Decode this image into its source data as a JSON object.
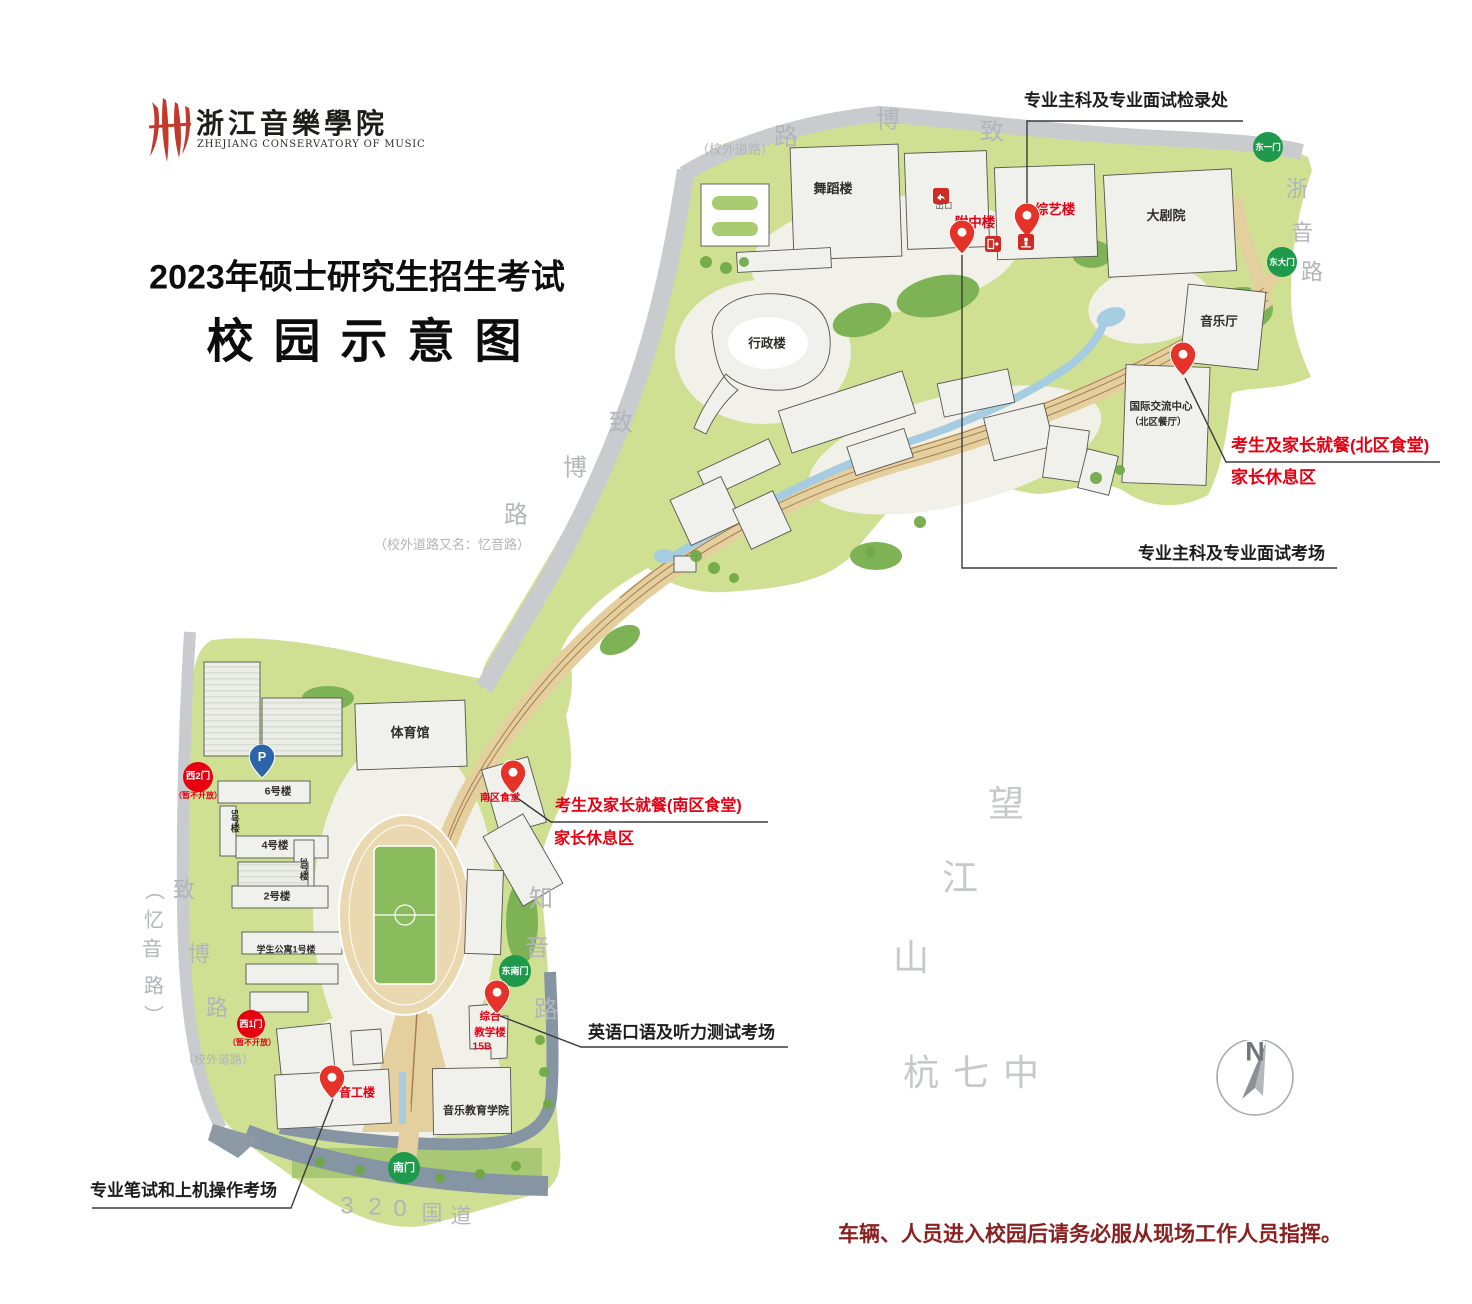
{
  "header": {
    "logo_cn": "浙江音樂學院",
    "logo_en": "ZHEJIANG CONSERVATORY OF MUSIC",
    "title_line1": "2023年硕士研究生招生考试",
    "title_line2": "校园示意图"
  },
  "map": {
    "notice": "车辆、人员进入校园后请务必服从现场工作人员指挥。",
    "compass_n": "N",
    "colors": {
      "campus_green": "#cfe092",
      "dark_green": "#7db354",
      "road_gray": "#c9cbce",
      "road_blue_gray": "#8695a4",
      "path_tan": "#e4cf9f",
      "water_blue": "#a5cce0",
      "accent_red": "#e60012",
      "gate_green": "#1f9a4c",
      "notice_dark_red": "#8a2121"
    },
    "labels": [
      {
        "n": "building-label-wudaolou",
        "t": "舞蹈楼",
        "x": 833,
        "y": 189,
        "fs": 13,
        "c": "b"
      },
      {
        "n": "building-label-dajuyuan",
        "t": "大剧院",
        "x": 1166,
        "y": 216,
        "fs": 13,
        "c": "b"
      },
      {
        "n": "building-label-yinyueting",
        "t": "音乐厅",
        "x": 1219,
        "y": 322,
        "fs": 12.5,
        "c": "b"
      },
      {
        "n": "building-label-xingzhenglou",
        "t": "行政楼",
        "x": 767,
        "y": 344,
        "fs": 12.5,
        "c": "b"
      },
      {
        "n": "building-label-guojijiaoliu",
        "t": "国际交流中心",
        "x": 1161,
        "y": 407,
        "fs": 10.5,
        "c": "b"
      },
      {
        "n": "building-label-beiqucanting",
        "t": "（北区餐厅）",
        "x": 1158,
        "y": 423,
        "fs": 9.5,
        "c": "b"
      },
      {
        "n": "building-label-tiyuguan",
        "t": "体育馆",
        "x": 410,
        "y": 733,
        "fs": 13,
        "c": "b"
      },
      {
        "n": "building-label-6haolou",
        "t": "6号楼",
        "x": 278,
        "y": 792,
        "fs": 10.5,
        "c": "b"
      },
      {
        "n": "building-label-4haolou",
        "t": "4号楼",
        "x": 275,
        "y": 846,
        "fs": 10.5,
        "c": "b"
      },
      {
        "n": "building-label-2haolou",
        "t": "2号楼",
        "x": 277,
        "y": 897,
        "fs": 10.5,
        "c": "b"
      },
      {
        "n": "building-label-5haolou",
        "t": "5号楼",
        "x": 234,
        "y": 821,
        "fs": 9,
        "c": "b",
        "v": true
      },
      {
        "n": "building-label-3haolou",
        "t": "3号楼",
        "x": 303,
        "y": 869,
        "fs": 9,
        "c": "b",
        "v": true
      },
      {
        "n": "building-label-xueshengongyu",
        "t": "学生公寓1号楼",
        "x": 286,
        "y": 950,
        "fs": 9,
        "c": "b"
      },
      {
        "n": "building-label-yinyuejiaoyu",
        "t": "音乐教育学院",
        "x": 476,
        "y": 1112,
        "fs": 11,
        "c": "b"
      },
      {
        "n": "exit-label",
        "t": "出口",
        "x": 944,
        "y": 206,
        "fs": 8.5,
        "c": "dim"
      },
      {
        "n": "building-label-fuzhonglou",
        "t": "附中楼",
        "x": 975,
        "y": 223,
        "fs": 13.5,
        "c": "r"
      },
      {
        "n": "building-label-zongyilou",
        "t": "综艺楼",
        "x": 1055,
        "y": 210,
        "fs": 13.5,
        "c": "r"
      },
      {
        "n": "building-label-nanqushitang",
        "t": "南区食堂",
        "x": 500,
        "y": 799,
        "fs": 10,
        "c": "r"
      },
      {
        "n": "building-label-zonghe",
        "t": "综合",
        "x": 490,
        "y": 1017,
        "fs": 10.5,
        "c": "r"
      },
      {
        "n": "building-label-jiaoxuelou",
        "t": "教学楼",
        "x": 490,
        "y": 1033,
        "fs": 10.5,
        "c": "r"
      },
      {
        "n": "building-label-15b",
        "t": "15B",
        "x": 482,
        "y": 1047,
        "fs": 10.5,
        "c": "r"
      },
      {
        "n": "building-label-yingonglou",
        "t": "音工楼",
        "x": 357,
        "y": 1093,
        "fs": 12,
        "c": "r"
      },
      {
        "n": "annotation-checkin",
        "t": "专业主科及专业面试检录处",
        "x": 1024,
        "y": 101,
        "fs": 17,
        "c": "an",
        "a": "l"
      },
      {
        "n": "annotation-interview-room",
        "t": "专业主科及专业面试考场",
        "x": 1138,
        "y": 554,
        "fs": 17,
        "c": "an",
        "a": "l"
      },
      {
        "n": "annotation-north-dining-1",
        "t": "考生及家长就餐(北区食堂)",
        "x": 1231,
        "y": 446,
        "fs": 17,
        "c": "ar",
        "a": "l"
      },
      {
        "n": "annotation-north-dining-2",
        "t": "家长休息区",
        "x": 1231,
        "y": 478,
        "fs": 17,
        "c": "ar",
        "a": "l"
      },
      {
        "n": "annotation-south-dining-1",
        "t": "考生及家长就餐(南区食堂)",
        "x": 555,
        "y": 807,
        "fs": 16,
        "c": "ar",
        "a": "l"
      },
      {
        "n": "annotation-south-dining-2",
        "t": "家长休息区",
        "x": 554,
        "y": 840,
        "fs": 16,
        "c": "ar",
        "a": "l"
      },
      {
        "n": "annotation-english-test",
        "t": "英语口语及听力测试考场",
        "x": 588,
        "y": 1033,
        "fs": 17,
        "c": "an",
        "a": "l"
      },
      {
        "n": "annotation-written-test",
        "t": "专业笔试和上机操作考场",
        "x": 90,
        "y": 1191,
        "fs": 17,
        "c": "an",
        "a": "l"
      },
      {
        "n": "gate-note-west2",
        "t": "（暂不开放）",
        "x": 198,
        "y": 796,
        "fs": 8,
        "c": "r"
      },
      {
        "n": "gate-note-west1",
        "t": "（暂不开放）",
        "x": 252,
        "y": 1043,
        "fs": 8,
        "c": "r"
      },
      {
        "n": "road-note-top",
        "t": "（校外道路）",
        "x": 735,
        "y": 150,
        "fs": 13,
        "c": "g"
      },
      {
        "n": "road-label-lu-top",
        "t": "路",
        "x": 786,
        "y": 137,
        "fs": 24,
        "c": "g"
      },
      {
        "n": "road-label-bo-top",
        "t": "博",
        "x": 888,
        "y": 120,
        "fs": 24,
        "c": "g"
      },
      {
        "n": "road-label-zhi-top",
        "t": "致",
        "x": 992,
        "y": 132,
        "fs": 24,
        "c": "g"
      },
      {
        "n": "road-label-zhe",
        "t": "浙",
        "x": 1297,
        "y": 189,
        "fs": 22,
        "c": "g"
      },
      {
        "n": "road-label-yin-east",
        "t": "音",
        "x": 1302,
        "y": 233,
        "fs": 22,
        "c": "g"
      },
      {
        "n": "road-label-lu-east",
        "t": "路",
        "x": 1312,
        "y": 272,
        "fs": 22,
        "c": "g"
      },
      {
        "n": "road-label-zhi-mid",
        "t": "致",
        "x": 621,
        "y": 423,
        "fs": 24,
        "c": "g"
      },
      {
        "n": "road-label-bo-mid",
        "t": "博",
        "x": 575,
        "y": 468,
        "fs": 24,
        "c": "g"
      },
      {
        "n": "road-label-lu-mid",
        "t": "路",
        "x": 516,
        "y": 515,
        "fs": 24,
        "c": "g"
      },
      {
        "n": "road-note-mid",
        "t": "（校外道路又名：忆音路）",
        "x": 452,
        "y": 545,
        "fs": 13,
        "c": "g"
      },
      {
        "n": "road-label-paren-open",
        "t": "（",
        "x": 152,
        "y": 890,
        "fs": 20,
        "c": "g",
        "v": true
      },
      {
        "n": "road-label-yi-west",
        "t": "忆",
        "x": 154,
        "y": 921,
        "fs": 20,
        "c": "g"
      },
      {
        "n": "road-label-yin-west",
        "t": "音",
        "x": 152,
        "y": 950,
        "fs": 20,
        "c": "g"
      },
      {
        "n": "road-label-lu-west",
        "t": "路",
        "x": 154,
        "y": 987,
        "fs": 20,
        "c": "g"
      },
      {
        "n": "road-label-paren-close",
        "t": "）",
        "x": 151,
        "y": 1015,
        "fs": 20,
        "c": "g",
        "v": true
      },
      {
        "n": "road-label-zhi-sw",
        "t": "致",
        "x": 184,
        "y": 890,
        "fs": 22,
        "c": "g"
      },
      {
        "n": "road-label-bo-sw",
        "t": "博",
        "x": 199,
        "y": 954,
        "fs": 22,
        "c": "g"
      },
      {
        "n": "road-label-lu-sw",
        "t": "路",
        "x": 217,
        "y": 1008,
        "fs": 22,
        "c": "g"
      },
      {
        "n": "road-note-sw",
        "t": "（校外道路）",
        "x": 218,
        "y": 1060,
        "fs": 12,
        "c": "g"
      },
      {
        "n": "road-label-zhi2",
        "t": "知",
        "x": 541,
        "y": 899,
        "fs": 24,
        "c": "g"
      },
      {
        "n": "road-label-yin2",
        "t": "音",
        "x": 537,
        "y": 948,
        "fs": 24,
        "c": "g"
      },
      {
        "n": "road-label-lu2",
        "t": "路",
        "x": 546,
        "y": 1010,
        "fs": 24,
        "c": "g"
      },
      {
        "n": "area-label-wang",
        "t": "望",
        "x": 1006,
        "y": 804,
        "fs": 36,
        "c": "lg"
      },
      {
        "n": "area-label-jiang",
        "t": "江",
        "x": 960,
        "y": 878,
        "fs": 36,
        "c": "lg"
      },
      {
        "n": "area-label-shan",
        "t": "山",
        "x": 911,
        "y": 958,
        "fs": 36,
        "c": "lg"
      },
      {
        "n": "area-label-hangqizhong",
        "t": "杭七中",
        "x": 978,
        "y": 1073,
        "fs": 36,
        "c": "lg",
        "ls": 14
      },
      {
        "n": "road-label-320-3",
        "t": "3",
        "x": 347,
        "y": 1206,
        "fs": 24,
        "c": "g"
      },
      {
        "n": "road-label-320-2",
        "t": "2",
        "x": 375,
        "y": 1207,
        "fs": 24,
        "c": "g"
      },
      {
        "n": "road-label-320-0",
        "t": "0",
        "x": 400,
        "y": 1209,
        "fs": 24,
        "c": "g"
      },
      {
        "n": "road-label-320-guo",
        "t": "国",
        "x": 432,
        "y": 1214,
        "fs": 21,
        "c": "g"
      },
      {
        "n": "road-label-320-dao",
        "t": "道",
        "x": 461,
        "y": 1217,
        "fs": 21,
        "c": "g"
      }
    ],
    "gates": [
      {
        "n": "gate-dongyimen",
        "t": "东一门",
        "x": 1268,
        "y": 147,
        "r": 15,
        "fs": 8.5,
        "c": "green"
      },
      {
        "n": "gate-dongdamen",
        "t": "东大门",
        "x": 1282,
        "y": 262,
        "r": 15,
        "fs": 8.5,
        "c": "green"
      },
      {
        "n": "gate-dongnanmen",
        "t": "东南门",
        "x": 515,
        "y": 971,
        "r": 16,
        "fs": 9,
        "c": "green"
      },
      {
        "n": "gate-nanmen",
        "t": "南门",
        "x": 404,
        "y": 1168,
        "r": 16,
        "fs": 11,
        "c": "green"
      },
      {
        "n": "gate-xi2men",
        "t": "西2门",
        "x": 198,
        "y": 777,
        "r": 15,
        "fs": 9.5,
        "c": "redg"
      },
      {
        "n": "gate-xi1men",
        "t": "西1门",
        "x": 251,
        "y": 1024,
        "r": 14,
        "fs": 9,
        "c": "redg"
      }
    ],
    "pins": [
      {
        "n": "pin-fuzhonglou",
        "x": 962,
        "y": 253,
        "k": "red"
      },
      {
        "n": "pin-zongyilou",
        "x": 1027,
        "y": 236,
        "k": "red"
      },
      {
        "n": "pin-north-dining",
        "x": 1183,
        "y": 375,
        "k": "red"
      },
      {
        "n": "pin-south-dining",
        "x": 513,
        "y": 793,
        "k": "red"
      },
      {
        "n": "pin-zonghejiaoxuelou",
        "x": 497,
        "y": 1013,
        "k": "red"
      },
      {
        "n": "pin-yingonglou",
        "x": 332,
        "y": 1098,
        "k": "red"
      },
      {
        "n": "parking-pin",
        "x": 262,
        "y": 777,
        "k": "blue",
        "t": "P"
      }
    ],
    "icons": [
      {
        "n": "exit-icon",
        "x": 933,
        "y": 188,
        "k": "exit"
      },
      {
        "n": "exit-gate-icon",
        "x": 985,
        "y": 236,
        "k": "exit2"
      },
      {
        "n": "checkpoint-icon",
        "x": 1018,
        "y": 234,
        "k": "check"
      }
    ],
    "lines": [
      {
        "n": "leader-checkin",
        "pts": [
          [
            1243,
            121
          ],
          [
            1027,
            121
          ],
          [
            1027,
            232
          ]
        ]
      },
      {
        "n": "leader-interview-room",
        "pts": [
          [
            962,
            255
          ],
          [
            962,
            568
          ],
          [
            1337,
            568
          ]
        ]
      },
      {
        "n": "leader-north-dining",
        "pts": [
          [
            1185,
            378
          ],
          [
            1226,
            462
          ],
          [
            1440,
            462
          ]
        ]
      },
      {
        "n": "leader-south-dining",
        "pts": [
          [
            513,
            795
          ],
          [
            551,
            822
          ],
          [
            768,
            822
          ]
        ]
      },
      {
        "n": "leader-english-test",
        "pts": [
          [
            500,
            1016
          ],
          [
            581,
            1047
          ],
          [
            788,
            1047
          ]
        ]
      },
      {
        "n": "leader-written-test",
        "pts": [
          [
            333,
            1099
          ],
          [
            291,
            1208
          ],
          [
            92,
            1208
          ]
        ]
      }
    ]
  }
}
